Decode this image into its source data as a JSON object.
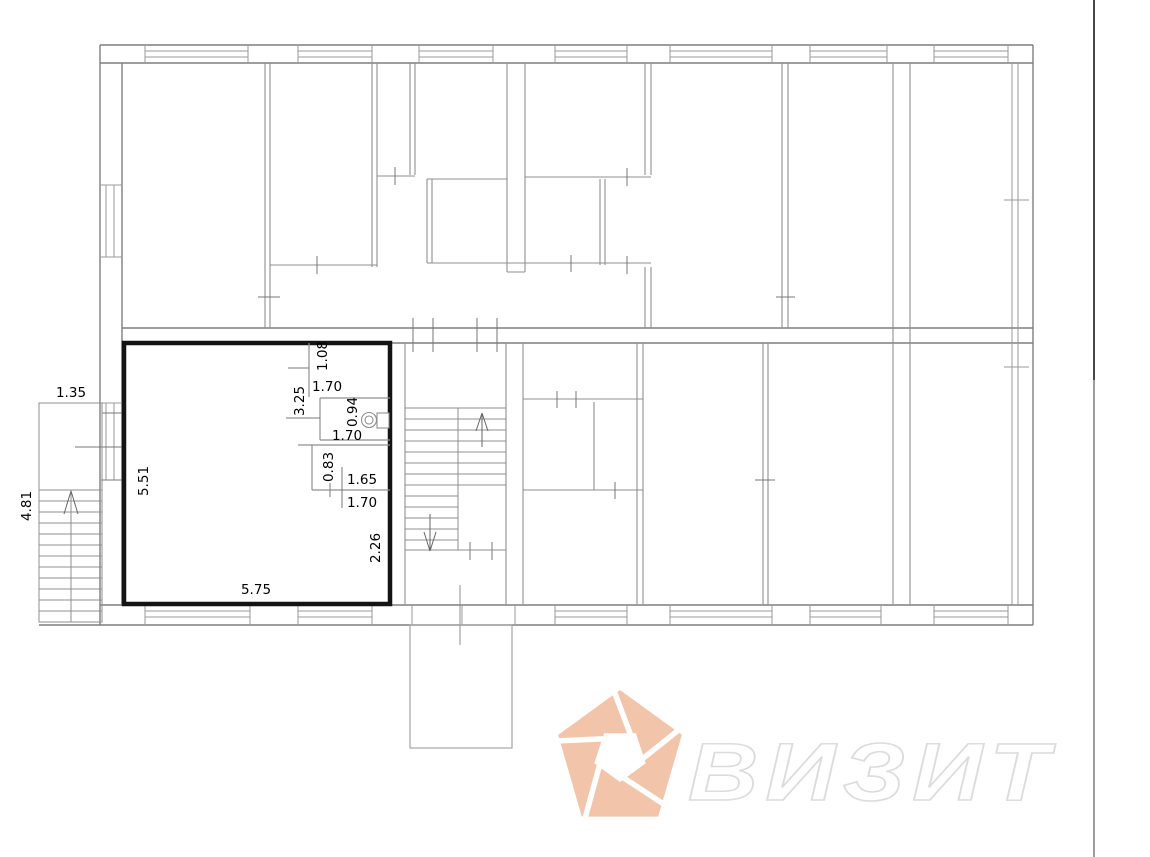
{
  "plan": {
    "type": "floor-plan",
    "dimensions": [
      {
        "text": "1.35"
      },
      {
        "text": "4.81"
      },
      {
        "text": "5.51"
      },
      {
        "text": "5.75"
      },
      {
        "text": "1.08"
      },
      {
        "text": "1.70"
      },
      {
        "text": "3.25"
      },
      {
        "text": "0.94"
      },
      {
        "text": "1.70"
      },
      {
        "text": "0.83"
      },
      {
        "text": "1.65"
      },
      {
        "text": "1.70"
      },
      {
        "text": "2.26"
      }
    ]
  },
  "icons": {
    "stair_up_arrow": "chevron-up",
    "stair_down_arrow": "chevron-down",
    "toilet_symbol": "toilet-plan-symbol",
    "logo": "pentagon-aperture-logo"
  },
  "watermark": {
    "text": "ВИЗИТ",
    "logo_color": "#f2c5aa",
    "text_outline_color": "#dcdcdc"
  },
  "colors": {
    "background": "#ffffff",
    "wall": "#7f7f7f",
    "partition": "#8f8f8f",
    "window": "#9a9a9a",
    "unit_border": "#141414",
    "edge_line_top": "#1a1a1a",
    "edge_line_bottom": "#9e9e9e"
  }
}
